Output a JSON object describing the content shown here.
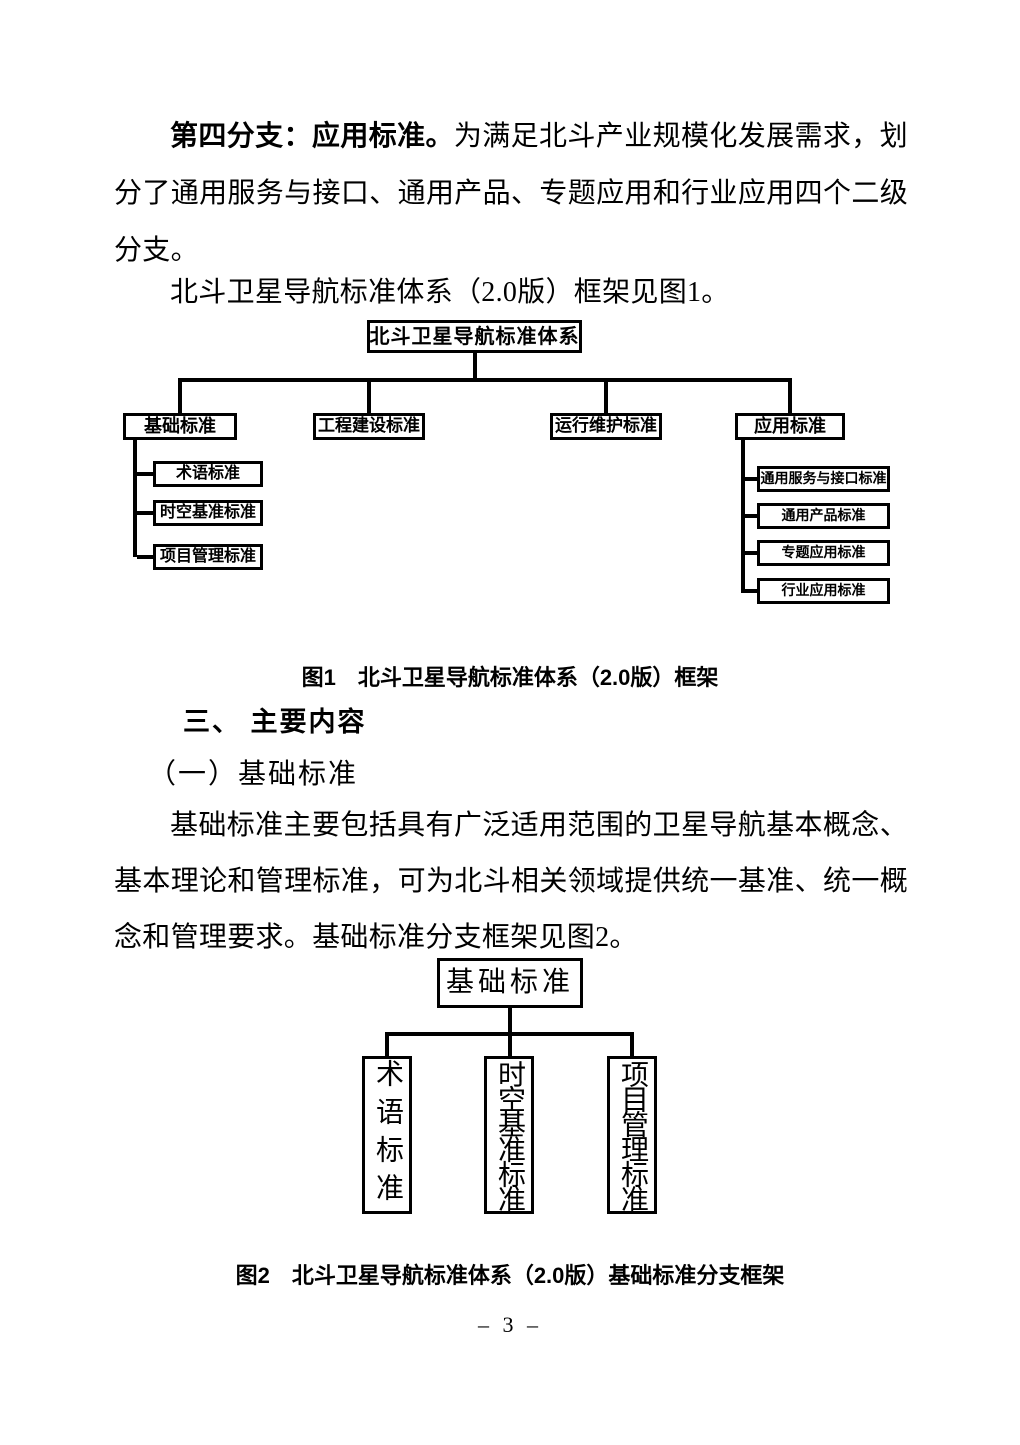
{
  "doc": {
    "paragraphs": {
      "branch4_lead": "第四分支：应用标准。",
      "branch4_body": "为满足北斗产业规模化发展需求，划分了通用服务与接口、通用产品、专题应用和行业应用四个二级分支。",
      "figure1_intro": "北斗卫星导航标准体系（2.0版）框架见图1。",
      "basic_desc": "基础标准主要包括具有广泛适用范围的卫星导航基本概念、基本理论和管理标准，可为北斗相关领域提供统一基准、统一概念和管理要求。基础标准分支框架见图2。"
    },
    "headings": {
      "section": "三、 主要内容",
      "subsection": "（一）基础标准"
    },
    "figure1": {
      "caption": "图1　北斗卫星导航标准体系（2.0版）框架",
      "root": "北斗卫星导航标准体系",
      "branches": [
        {
          "label": "基础标准",
          "children": [
            "术语标准",
            "时空基准标准",
            "项目管理标准"
          ]
        },
        {
          "label": "工程建设标准",
          "children": []
        },
        {
          "label": "运行维护标准",
          "children": []
        },
        {
          "label": "应用标准",
          "children": [
            "通用服务与接口标准",
            "通用产品标准",
            "专题应用标准",
            "行业应用标准"
          ]
        }
      ]
    },
    "figure2": {
      "caption": "图2　北斗卫星导航标准体系（2.0版）基础标准分支框架",
      "root": "基础标准",
      "children": [
        "术语标准",
        "时空基准标准",
        "项目管理标准"
      ]
    },
    "page_number": "– 3 –"
  }
}
